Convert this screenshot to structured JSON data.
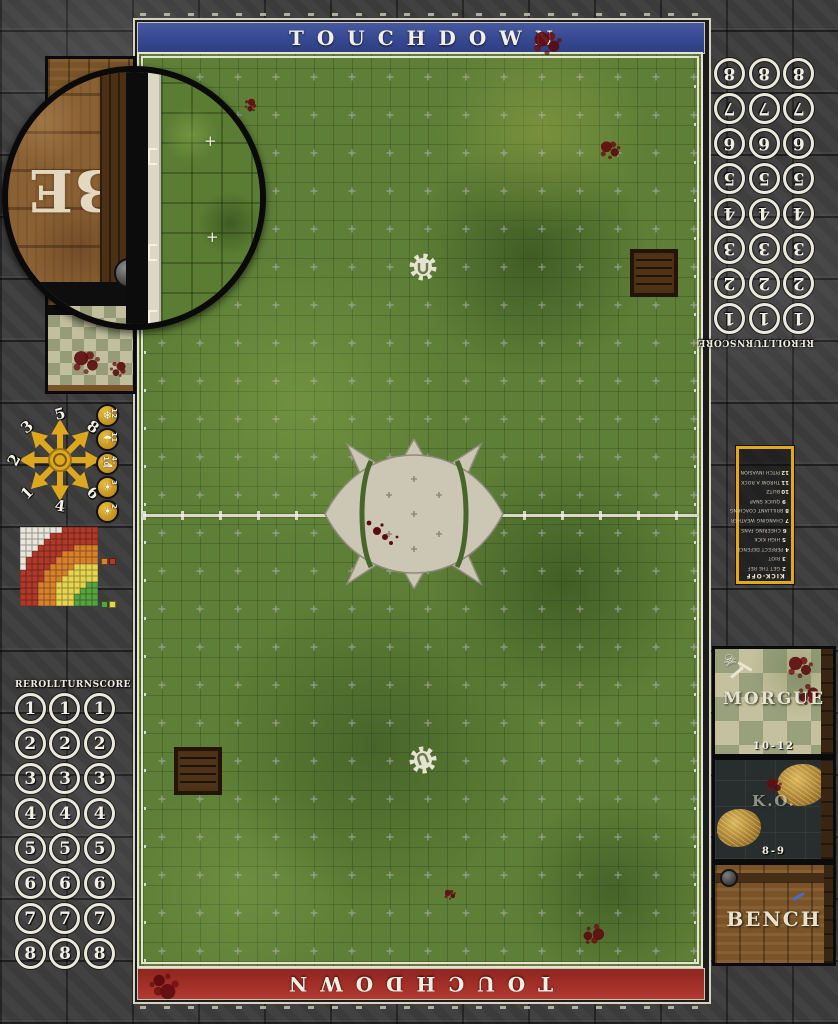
{
  "banners": {
    "top_label": "TOUCHDOWN",
    "bottom_label": "TOUCHDOWN",
    "top_color": "#35478f",
    "bottom_color": "#9e2c26"
  },
  "tracker": {
    "headers": [
      "REROLL",
      "TURN",
      "SCORE"
    ],
    "values": [
      "1",
      "2",
      "3",
      "4",
      "5",
      "6",
      "7",
      "8"
    ],
    "columns": 3
  },
  "scatter_template": {
    "directions": [
      {
        "dir": "N",
        "label": "5"
      },
      {
        "dir": "NE",
        "label": "8"
      },
      {
        "dir": "E",
        "label": "7"
      },
      {
        "dir": "SE",
        "label": "6"
      },
      {
        "dir": "S",
        "label": "4"
      },
      {
        "dir": "SW",
        "label": "1"
      },
      {
        "dir": "W",
        "label": "2"
      },
      {
        "dir": "NW",
        "label": "3"
      }
    ]
  },
  "weather_track": [
    {
      "roll": "12",
      "icon": "blizzard-icon",
      "glyph": "❄"
    },
    {
      "roll": "11",
      "icon": "rain-icon",
      "glyph": "☂"
    },
    {
      "roll": "4-10",
      "icon": "cloudy-icon",
      "glyph": "☁"
    },
    {
      "roll": "3",
      "icon": "sunny-icon",
      "glyph": "☀"
    },
    {
      "roll": "2",
      "icon": "sweltering-sun-icon",
      "glyph": "☀"
    }
  ],
  "pass_ruler": {
    "rows": [
      "WWWWWWWRRRRRR",
      "WWWWWRRRRRRRR",
      "WWWWRRRRRRRRR",
      "WWWRRRRRROOOO",
      "WWRRRRROOOOOO",
      "WRRRRROOOOOOO",
      "WRRRROOOOYYYY",
      "RRRROOOOYYYYY",
      "RRRROOOYYYYYY",
      "RRROOOYYYYYGG",
      "RRROOOYYYYGGG",
      "RRROOOYYYGGGG",
      "RRROOOYYYGGGG"
    ],
    "palette": {
      "W": "#e9e6da",
      "R": "#b03a2a",
      "O": "#d8812c",
      "Y": "#e6d34f",
      "G": "#57a33f"
    },
    "legend_top": [
      "O",
      "R"
    ],
    "legend_bottom": [
      "G",
      "Y"
    ]
  },
  "kickoff_table": {
    "title": "KICK-OFF",
    "entries": [
      {
        "roll": "2",
        "name": "GET THE REF"
      },
      {
        "roll": "3",
        "name": "RIOT"
      },
      {
        "roll": "4",
        "name": "PERFECT DEFENCE"
      },
      {
        "roll": "5",
        "name": "HIGH KICK"
      },
      {
        "roll": "6",
        "name": "CHEERING FANS"
      },
      {
        "roll": "7",
        "name": "CHANGING WEATHER"
      },
      {
        "roll": "8",
        "name": "BRILLIANT COACHING"
      },
      {
        "roll": "9",
        "name": "QUICK SNAP"
      },
      {
        "roll": "10",
        "name": "BLITZ"
      },
      {
        "roll": "11",
        "name": "THROW A ROCK"
      },
      {
        "roll": "12",
        "name": "PITCH INVASION"
      }
    ]
  },
  "dugout": {
    "morgue_label": "MORGUE",
    "morgue_range": "10-12",
    "ko_label": "K.O.",
    "ko_range": "8-9",
    "bench_label": "BENCH"
  },
  "magnifier": {
    "visible_text": "BE"
  }
}
